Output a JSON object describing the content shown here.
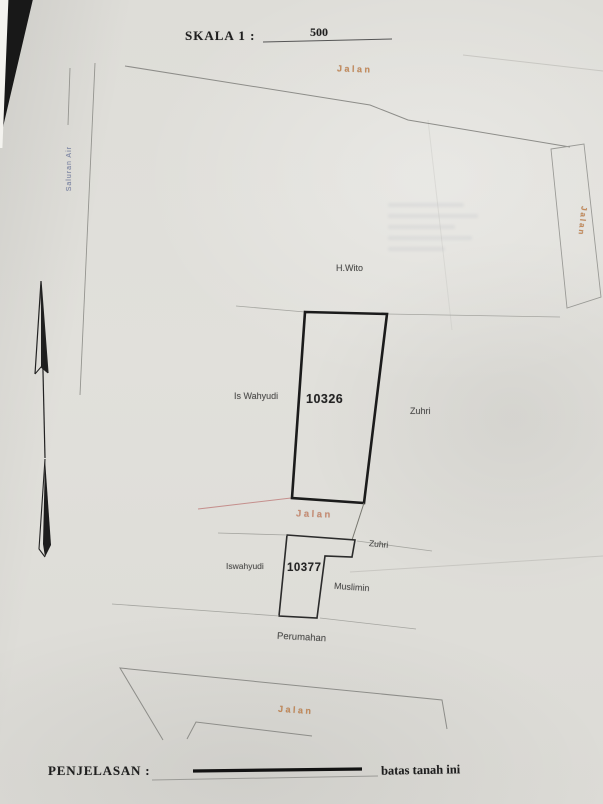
{
  "scale_bar": {
    "label": "SKALA 1 :",
    "value": "500"
  },
  "roads": {
    "top": "Jalan",
    "right": "Jalan",
    "middle": "Jalan",
    "bottom": "Jalan"
  },
  "waterway": {
    "label": "Saluran Air"
  },
  "plots": [
    {
      "id": "10326",
      "neighbors": {
        "north": "H.Wito",
        "west": "Is Wahyudi",
        "east": "Zuhri"
      }
    },
    {
      "id": "10377",
      "neighbors": {
        "west": "Iswahyudi",
        "northeast": "Zuhri",
        "east": "Muslimin",
        "south": "Perumahan"
      }
    }
  ],
  "legend": {
    "title": "PENJELASAN :",
    "boundary_label": "batas tanah ini"
  },
  "colors": {
    "boundary": "#1b1b1b",
    "road_label": "#c07c44",
    "waterway_label": "#66739e",
    "pink_line": "#c58f8d",
    "paper": "#dedddb"
  }
}
